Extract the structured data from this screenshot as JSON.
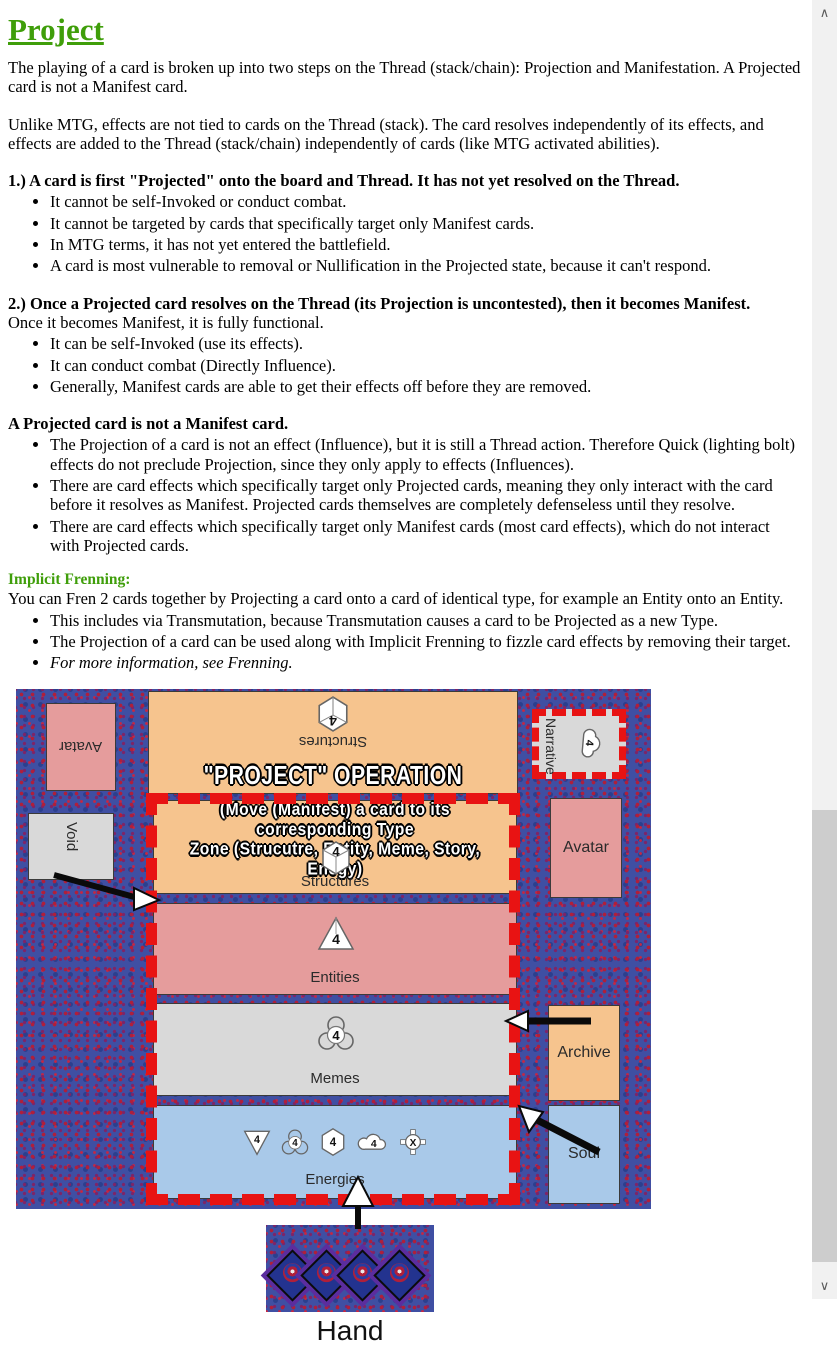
{
  "article": {
    "title": "Project",
    "intro1": "The playing of a card is broken up into two steps on the Thread (stack/chain): Projection and Manifestation. A Projected card is not a Manifest card.",
    "intro2": "Unlike MTG, effects are not tied to cards on the Thread (stack). The card resolves independently of its effects, and effects are added to the Thread (stack/chain) independently of cards (like MTG activated abilities).",
    "sections": [
      {
        "heading": "1.) A card is first \"Projected\" onto the board and Thread. It has not yet resolved on the Thread.",
        "bullets": [
          "It cannot be self-Invoked or conduct combat.",
          "It cannot be targeted by cards that specifically target only Manifest cards.",
          "In MTG terms, it has not yet entered the battlefield.",
          "A card is most vulnerable to removal or Nullification in the Projected state, because it can't respond."
        ]
      },
      {
        "heading": "2.) Once a Projected card resolves on the Thread (its Projection is uncontested), then it becomes Manifest.",
        "lead": "Once it becomes Manifest, it is fully functional.",
        "bullets": [
          "It can be self-Invoked (use its effects).",
          "It can conduct combat (Directly Influence).",
          "Generally, Manifest cards are able to get their effects off before they are removed."
        ]
      },
      {
        "heading": "A Projected card is not a Manifest card.",
        "bullets": [
          "The Projection of a card is not an effect (Influence), but it is still a Thread action. Therefore Quick (lighting bolt) effects do not preclude Projection, since they only apply to effects (Influences).",
          "There are card effects which specifically target only Projected cards, meaning they only interact with the card before it resolves as Manifest. Projected cards themselves are completely defenseless until they resolve.",
          "There are card effects which specifically target only Manifest cards (most card effects), which do not interact with Projected cards."
        ]
      }
    ],
    "frenning": {
      "heading": "Implicit Frenning:",
      "lead": "You can Fren 2 cards together by Projecting a card onto a card of identical type, for example an Entity onto an Entity.",
      "bullets": [
        "This includes via Transmutation, because Transmutation causes a card to be Projected as a new Type.",
        "The Projection of a card can be used along with Implicit Frenning to fizzle card effects by removing their target."
      ],
      "italic_bullet": "For more information, see Frenning."
    }
  },
  "diagram": {
    "operation_title": "\"PROJECT\" OPERATION",
    "note_line1": "(Move (Manifest) a card to its corresponding Type",
    "note_line2": "Zone (Strucutre, Entity, Meme, Story, Enegy)",
    "zones": {
      "opponent_structures": {
        "label": "Structures",
        "count": "4"
      },
      "player_structures": {
        "label": "Structures",
        "count": "4"
      },
      "entities": {
        "label": "Entities",
        "count": "4"
      },
      "memes": {
        "label": "Memes",
        "count": "4"
      },
      "energies": {
        "label": "Energies",
        "counts": [
          "4",
          "4",
          "4",
          "4",
          "X"
        ]
      }
    },
    "cards": {
      "avatar_top": "Avatar",
      "narrative": {
        "label": "Narrative",
        "count": "4"
      },
      "void": "Void",
      "avatar_right": "Avatar",
      "archive": "Archive",
      "soul": "Soul"
    },
    "hand_label": "Hand",
    "colors": {
      "zone_orange": "#f6c48e",
      "zone_pink": "#e59c9c",
      "zone_gray": "#d9d9d9",
      "zone_blue": "#a9c9e9",
      "dash_red": "#e81313",
      "accent_green": "#3f9e0a"
    }
  },
  "scrollbar": {
    "up": "∧",
    "down": "∨"
  }
}
